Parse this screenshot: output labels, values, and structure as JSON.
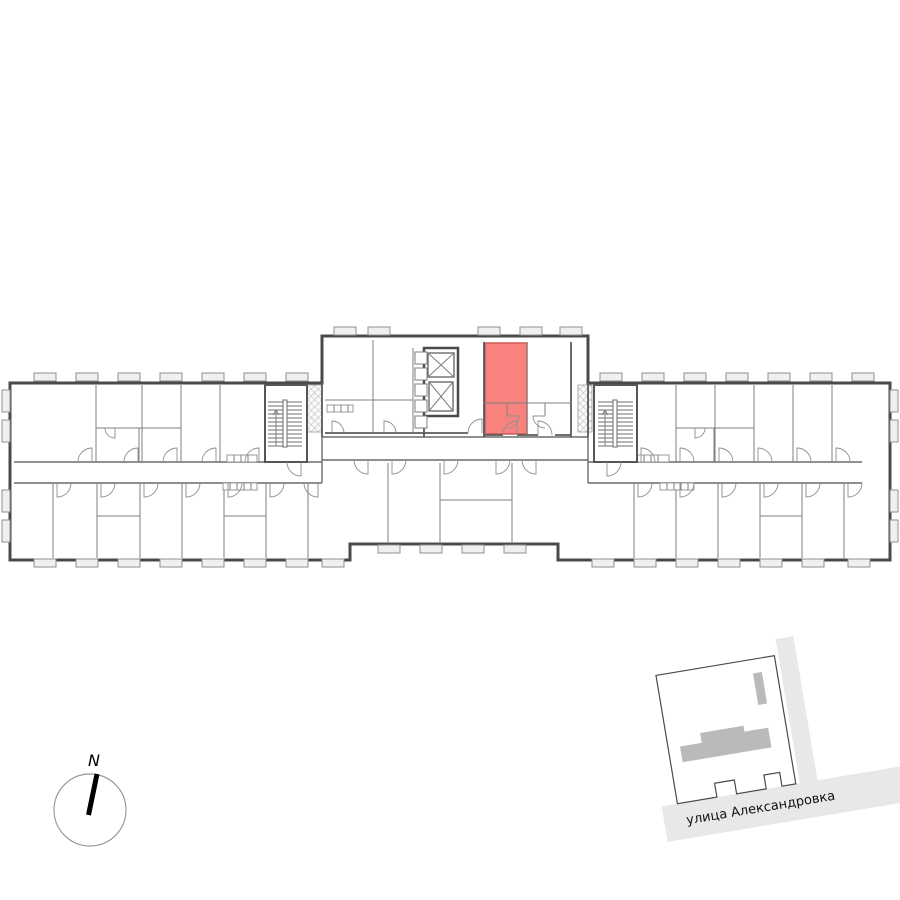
{
  "floorplan": {
    "type": "residential-floor-plan",
    "highlighted_unit": {
      "fill": "#f8837e",
      "stroke": "#d05a54"
    },
    "colors": {
      "outer_wall": "#4a4a4a",
      "interior_wall": "#7f7f7f",
      "window_fill": "#f0f0f0",
      "hatch": "#b5b5b5"
    }
  },
  "compass": {
    "label": "N"
  },
  "minimap": {
    "street_label": "улица Александровка",
    "colors": {
      "building": "#bababa",
      "street": "#e8e8e8",
      "parcel_outline": "#4a4a4a"
    }
  }
}
